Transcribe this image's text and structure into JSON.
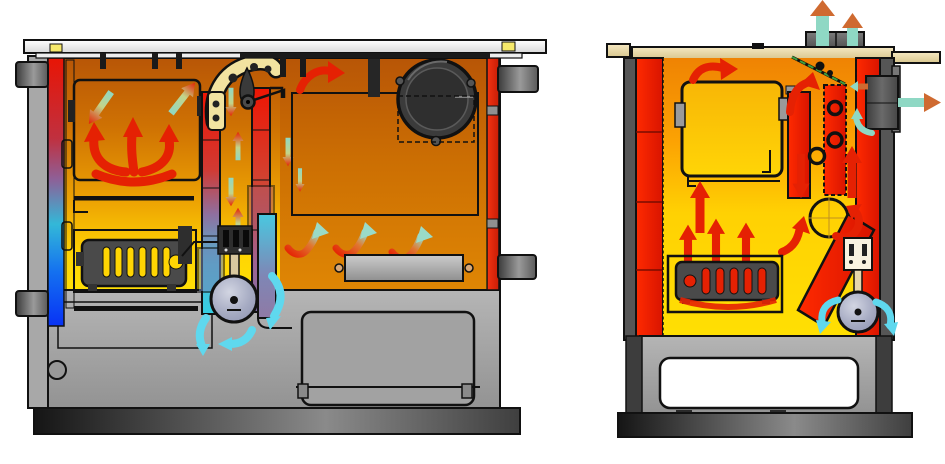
{
  "diagram": {
    "kind": "wood-fired cooker cutaway diagram",
    "views": [
      {
        "name": "front-section-view",
        "components": [
          "cooktop",
          "oven-chamber",
          "flame-arrows",
          "water-jacket-strip",
          "heat-exchanger-ducts",
          "damper-lever",
          "firebox-grate",
          "convection-fan",
          "smoke-chamber",
          "flue-collar",
          "cover-plate",
          "door-handles",
          "ash-drawer",
          "base-knob",
          "plinth"
        ]
      },
      {
        "name": "side-section-view",
        "components": [
          "chimney-stubs",
          "exhaust-arrows",
          "top-plate",
          "oven-box",
          "damper-rod",
          "flue-ducts",
          "flue-pipe-section",
          "flue-outlet-box",
          "diagonal-smoke-duct",
          "firebox-grate-side",
          "combustion-fan",
          "base-opening",
          "plinth"
        ]
      }
    ],
    "flow_legend": {
      "hot_flow_arrows": "red",
      "cooling_flow_arrows": "red-to-teal gradient",
      "fresh_air_arrows": "cyan",
      "exhaust_arrows": "teal body with orange head"
    }
  },
  "colors": {
    "background": "#ffffff",
    "flame-red": "#e52103",
    "hot-orange": "#e07800",
    "hot-yellow": "#ffd503",
    "cool-cyan": "#5fd8ee",
    "cool-teal": "#8fd8c4",
    "cool-blue": "#0a32f0",
    "exhaust-orange": "#cf6a30",
    "steel-gray": "#a8a8a8",
    "dark-steel": "#3d3d3d",
    "cream": "#f2e3a0",
    "tan": "#e7d7a8",
    "fan-lavender": "#a5aac2",
    "grate-dark": "#4a4a4a"
  }
}
